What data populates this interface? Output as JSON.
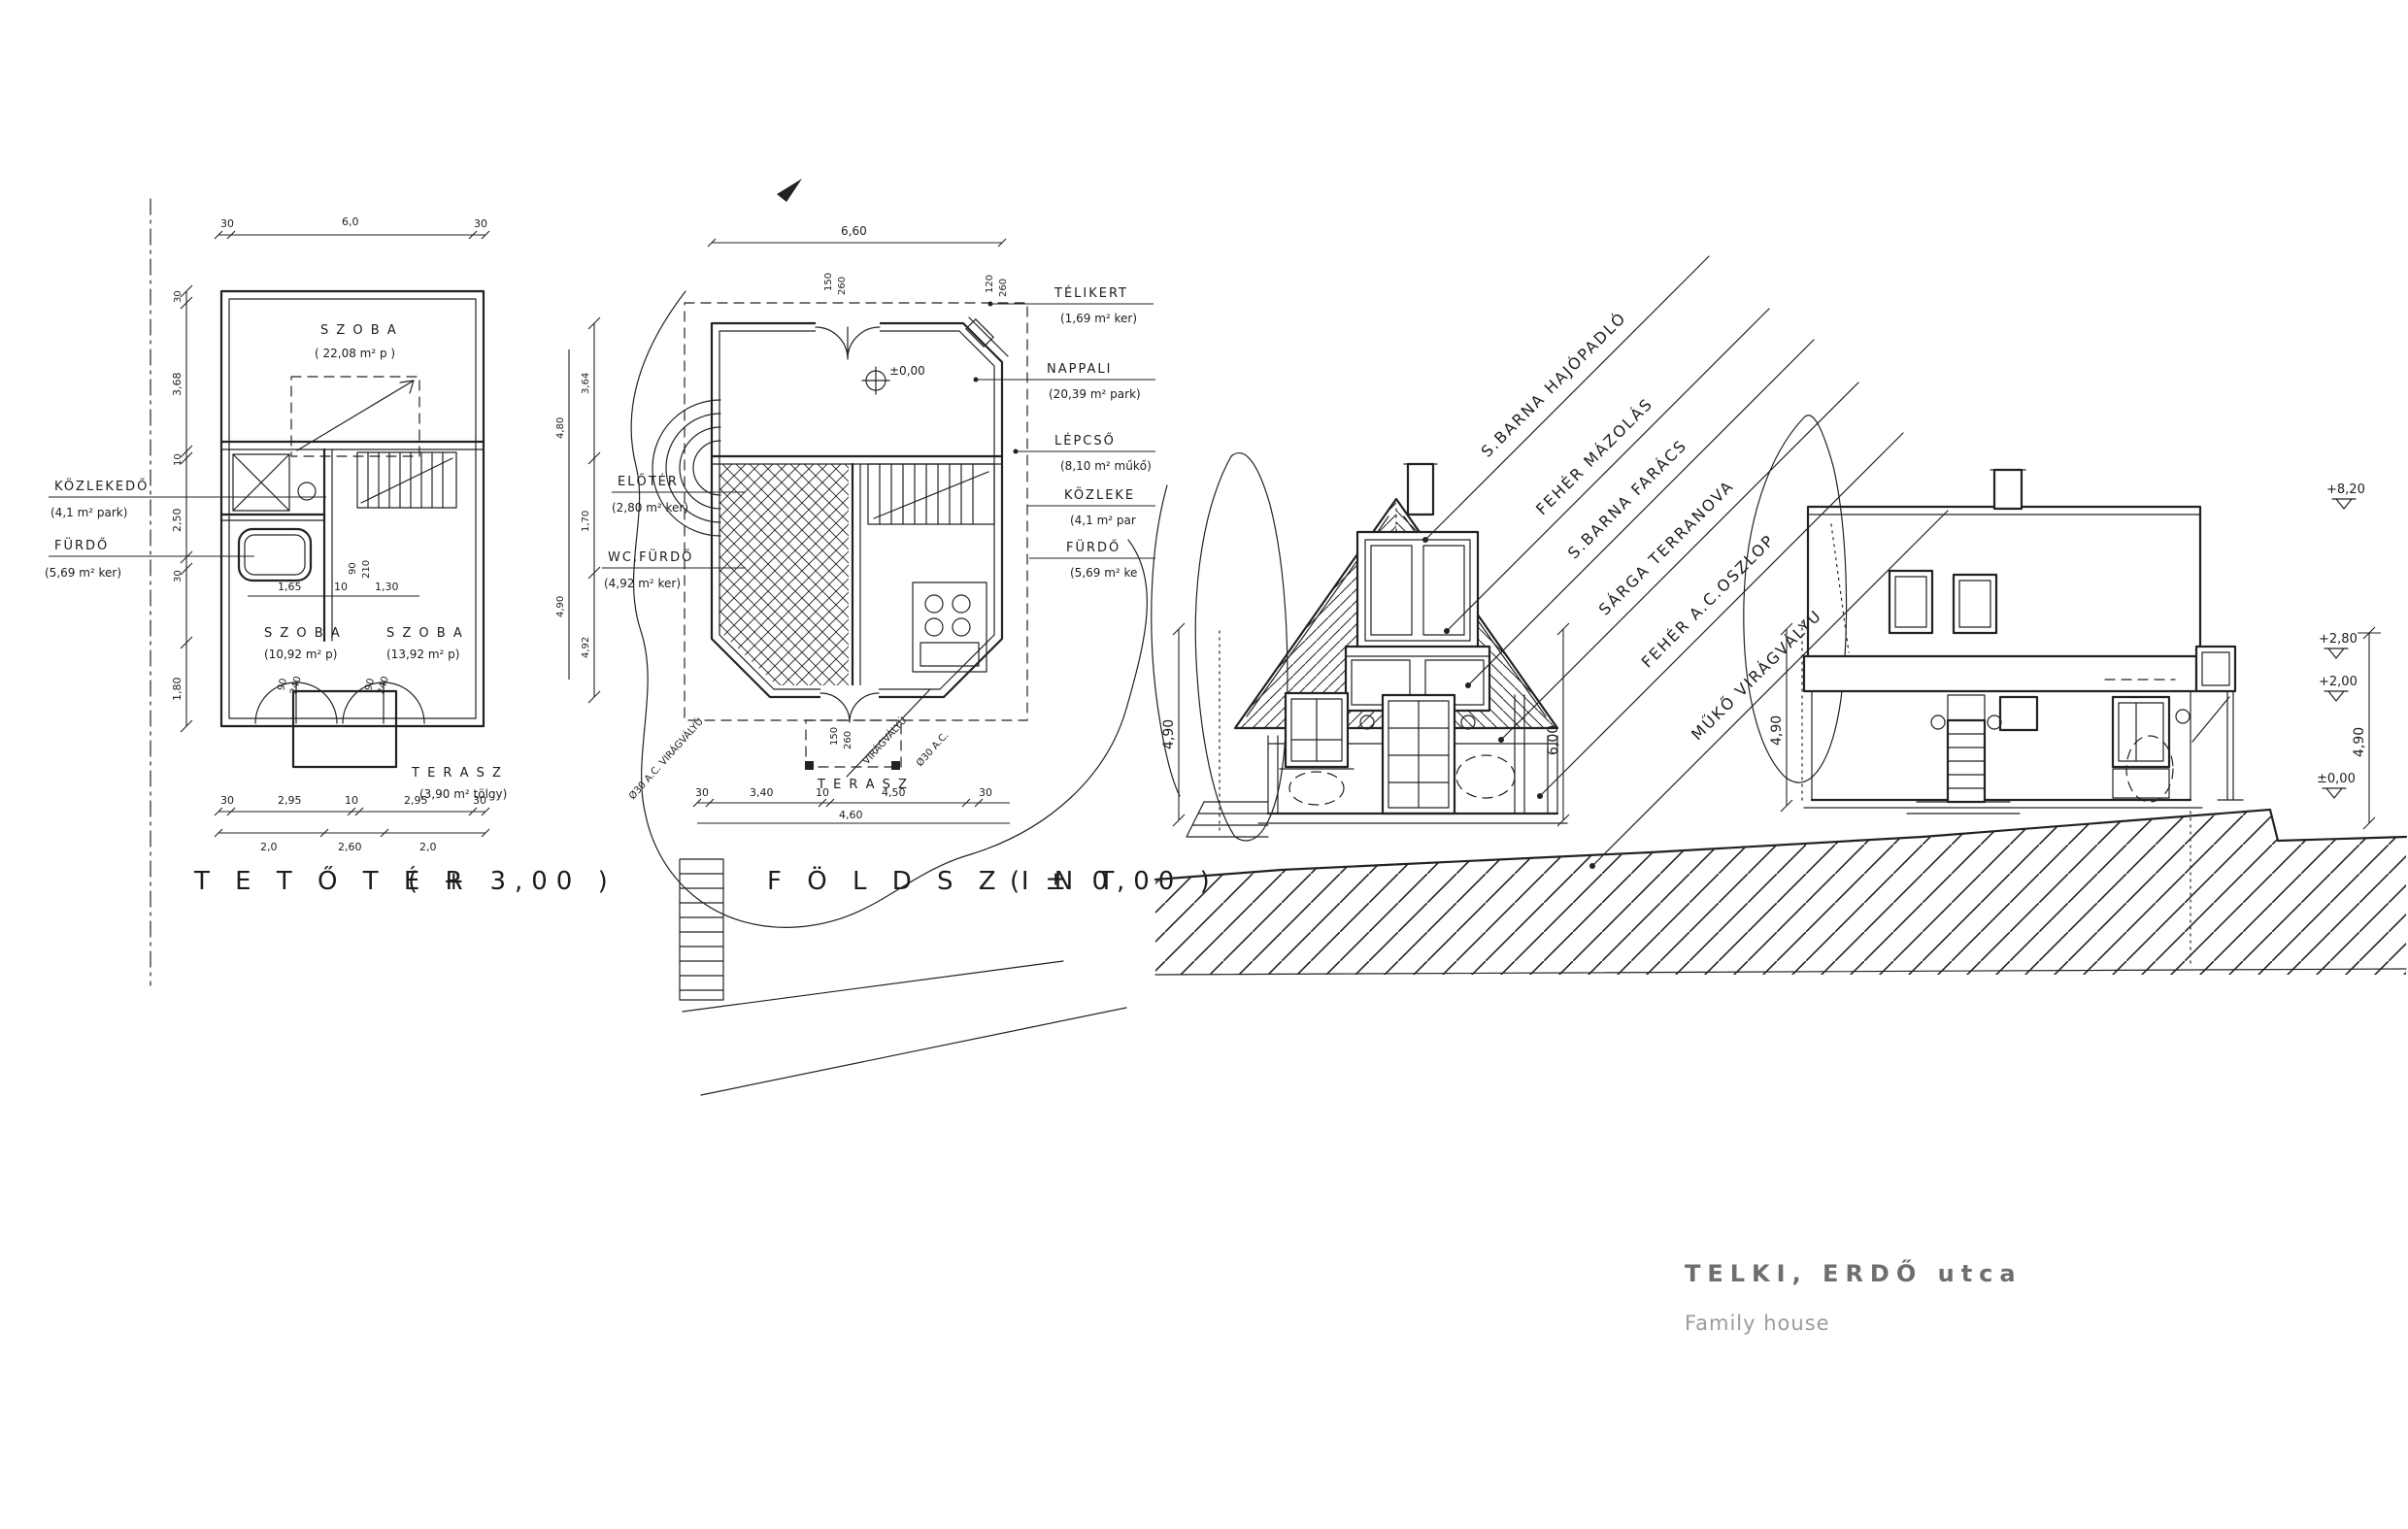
{
  "title_block": {
    "title": "TELKI, ERDŐ utca",
    "subtitle": "Family house"
  },
  "plan_tetoter": {
    "title": "T E T Ő T É R",
    "level": "( + 3,00 )",
    "rooms": {
      "szoba1": {
        "name": "S Z O B A",
        "area": "( 22,08 m² p )"
      },
      "kozlekedo": {
        "name": "KÖZLEKEDŐ",
        "area": "(4,1 m² park)"
      },
      "furdo": {
        "name": "FÜRDŐ",
        "area": "(5,69 m² ker)"
      },
      "szoba2": {
        "name": "S Z O B A",
        "area": "(10,92 m² p)"
      },
      "szoba3": {
        "name": "S Z O B A",
        "area": "(13,92 m² p)"
      },
      "terasz": {
        "name": "T E R A S Z",
        "area": "(3,90 m² tölgy)"
      }
    },
    "dims": {
      "top": [
        "30",
        "6,0",
        "30"
      ],
      "left": [
        "30",
        "3,68",
        "10",
        "2,50",
        "30",
        "1,80"
      ],
      "bottom1": [
        "30",
        "2,95",
        "10",
        "2,95",
        "30"
      ],
      "bottom2": [
        "2,0",
        "2,60",
        "2,0"
      ],
      "bath": [
        "1,65",
        "10",
        "1,30"
      ],
      "tub": [
        "90",
        "210"
      ],
      "door_a": [
        "90",
        "240"
      ],
      "door_b": [
        "90",
        "240"
      ]
    }
  },
  "plan_foldszint": {
    "title": "F Ö L D S Z I N T",
    "level": "( ± 0,00 )",
    "level_mark": "±0,00",
    "rooms": {
      "telikert": {
        "name": "TÉLIKERT",
        "area": "(1,69 m² ker)"
      },
      "nappali": {
        "name": "NAPPALI",
        "area": "(20,39 m² park)"
      },
      "lepcso": {
        "name": "LÉPCSŐ",
        "area": "(8,10 m² műkő)"
      },
      "kozlekedo": {
        "name": "KÖZLEKE",
        "area": "(4,1 m² par"
      },
      "furdo": {
        "name": "FÜRDŐ",
        "area": "(5,69 m² ke"
      },
      "eloter": {
        "name": "ELŐTÉR",
        "area": "(2,80 m² ker)"
      },
      "wcfurdo": {
        "name": "WC,FÜRDŐ",
        "area": "(4,92 m² ker)"
      },
      "terasz": {
        "name": "T E R A S Z"
      }
    },
    "notes": {
      "trough_right": "VIRÁGVÁLYÚ",
      "ac_right": "Ø30 A.C.",
      "trough_left": "Ø30 A.C. VIRÁGVÁLYÚ"
    },
    "dims": {
      "top": "6,60",
      "left_a": [
        "3,64",
        "1,70",
        "4,92"
      ],
      "left_b": [
        "4,80",
        "4,90"
      ],
      "bottom1": [
        "30",
        "3,40",
        "10",
        "4,50",
        "30"
      ],
      "bottom2": "4,60",
      "door_top": [
        "150",
        "260"
      ],
      "door_corner": [
        "120",
        "260"
      ],
      "door_terasz": [
        "150",
        "260"
      ]
    }
  },
  "elevation_front": {
    "annotations": [
      "S.BARNA HAJÓPADLÓ",
      "FEHÉR MÁZOLÁS",
      "S.BARNA FARÁCS",
      "SÁRGA TERRANOVA",
      "FEHÉR A.C.OSZLOP",
      "MŰKŐ VIRÁGVÁLYÚ"
    ],
    "dim_left": "4,90",
    "dim_right": "6,00"
  },
  "elevation_side": {
    "dim_left": "4,90",
    "dim_right": "4,90",
    "levels": [
      "+8,20",
      "+2,80",
      "+2,00",
      "±0,00"
    ]
  }
}
